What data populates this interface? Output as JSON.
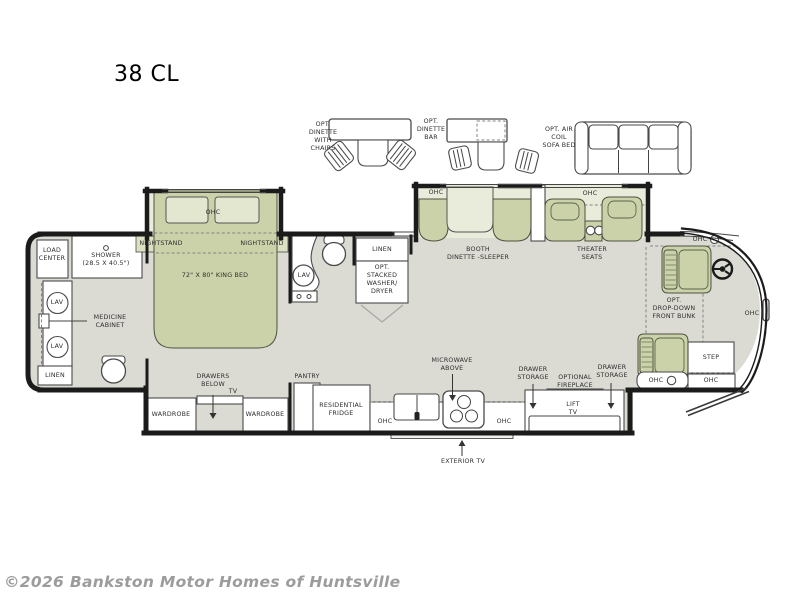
{
  "title": "38 CL",
  "watermark": "©2026 Bankston Motor Homes of Huntsville",
  "colors": {
    "floor": "#dbdbd4",
    "slide_floor": "#e9ebdb",
    "furniture": "#cbd2a9",
    "accent_band": "#dde1c2",
    "wall": "#1b1b1b",
    "label": "#2e2e2e",
    "watermark": "#9c9c9c"
  },
  "options": {
    "dinette_chairs": "OPT.\nDINETTE\nWITH\nCHAIRS",
    "dinette_bar": "OPT.\nDINETTE\nBAR",
    "air_coil_sofa": "OPT. AIR\nCOIL\nSOFA BED"
  },
  "labels": {
    "ohc": "OHC",
    "lav": "LAV",
    "linen": "LINEN",
    "nightstand": "NIGHTSTAND",
    "wardrobe": "WARDROBE",
    "drawer_storage": "DRAWER\nSTORAGE",
    "load_center": "LOAD\nCENTER",
    "shower": "SHOWER\n(28.5 X 40.5\")",
    "medicine_cabinet": "MEDICINE\nCABINET",
    "king_bed": "72\" X 80\" KING BED",
    "stacked_washer_dryer": "OPT.\nSTACKED\nWASHER/\nDRYER",
    "booth_dinette": "BOOTH\nDINETTE -SLEEPER",
    "theater_seats": "THEATER\nSEATS",
    "drawers_below": "DRAWERS\nBELOW",
    "tv": "TV",
    "pantry": "PANTRY",
    "residential_fridge": "RESIDENTIAL\nFRIDGE",
    "microwave_above": "MICROWAVE\nABOVE",
    "exterior_tv": "EXTERIOR TV",
    "optional_fireplace": "OPTIONAL\nFIREPLACE",
    "lift_tv": "LIFT\nTV",
    "drop_down_bunk": "OPT.\nDROP-DOWN\nFRONT BUNK",
    "step": "STEP"
  }
}
